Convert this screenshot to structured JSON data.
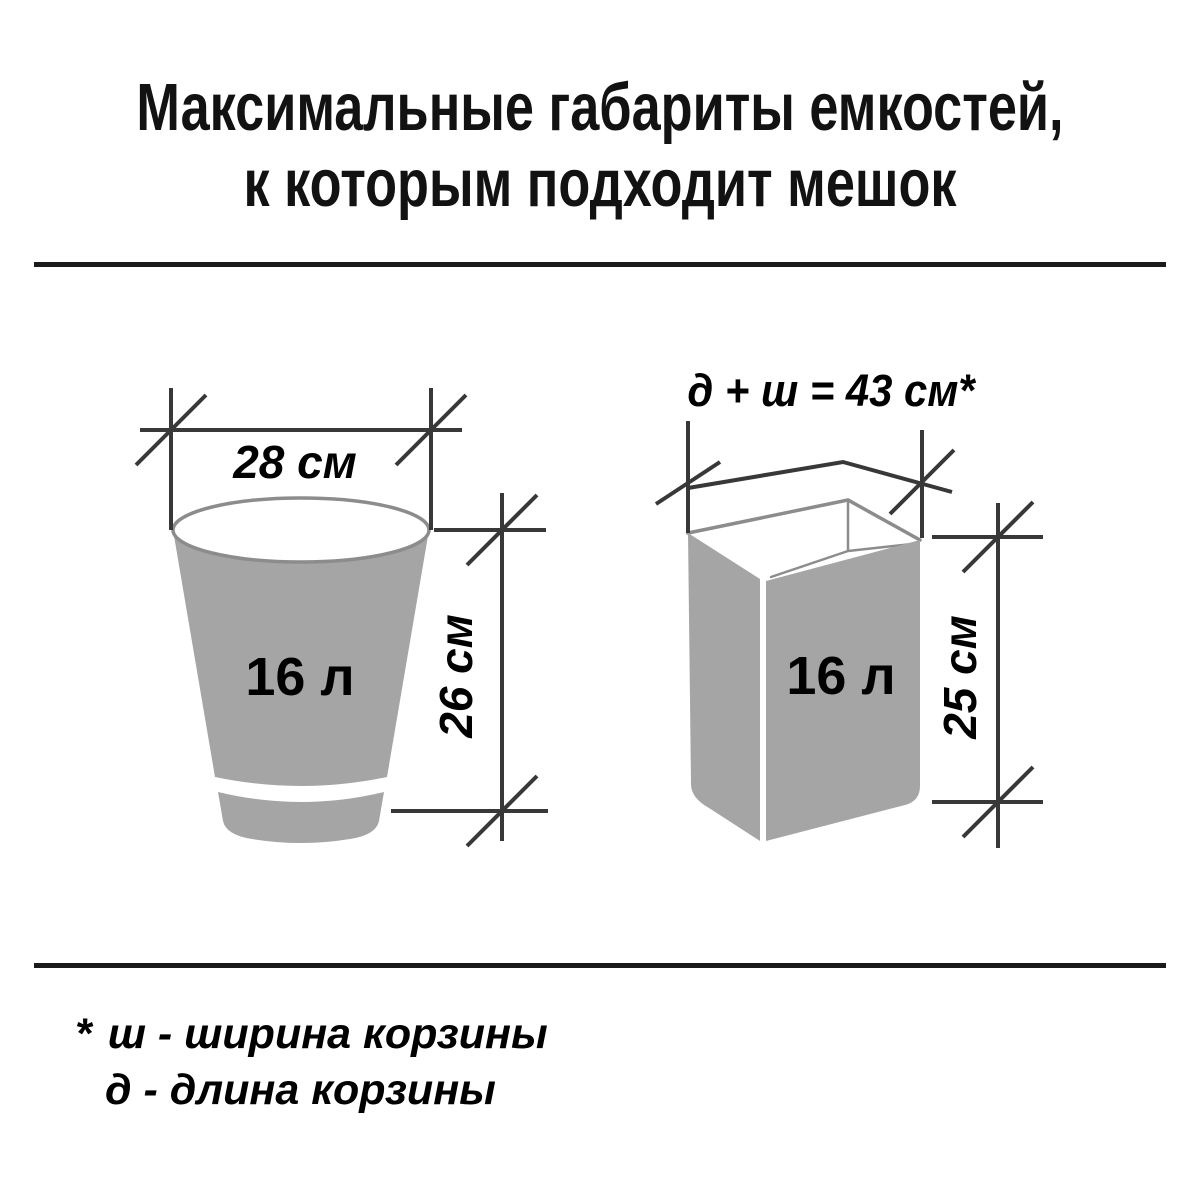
{
  "title": {
    "line1": "Максимальные габариты емкостей,",
    "line2": "к которым подходит мешок"
  },
  "figures": {
    "left": {
      "type": "round-bucket",
      "volume_label": "16 л",
      "width_label": "28 см",
      "height_label": "26 см"
    },
    "right": {
      "type": "rectangular-bin",
      "volume_label": "16 л",
      "perimeter_label": "д + ш = 43 см*",
      "height_label": "25 см"
    }
  },
  "footnote": {
    "marker": "*",
    "line1": "ш - ширина корзины",
    "line2": "д  - длина корзины"
  },
  "colors": {
    "fill_gray": "#a5a5a5",
    "outline_gray": "#8c8c8c",
    "line_dark": "#383838",
    "rule_dark": "#1a1a1a",
    "text": "#121212"
  }
}
